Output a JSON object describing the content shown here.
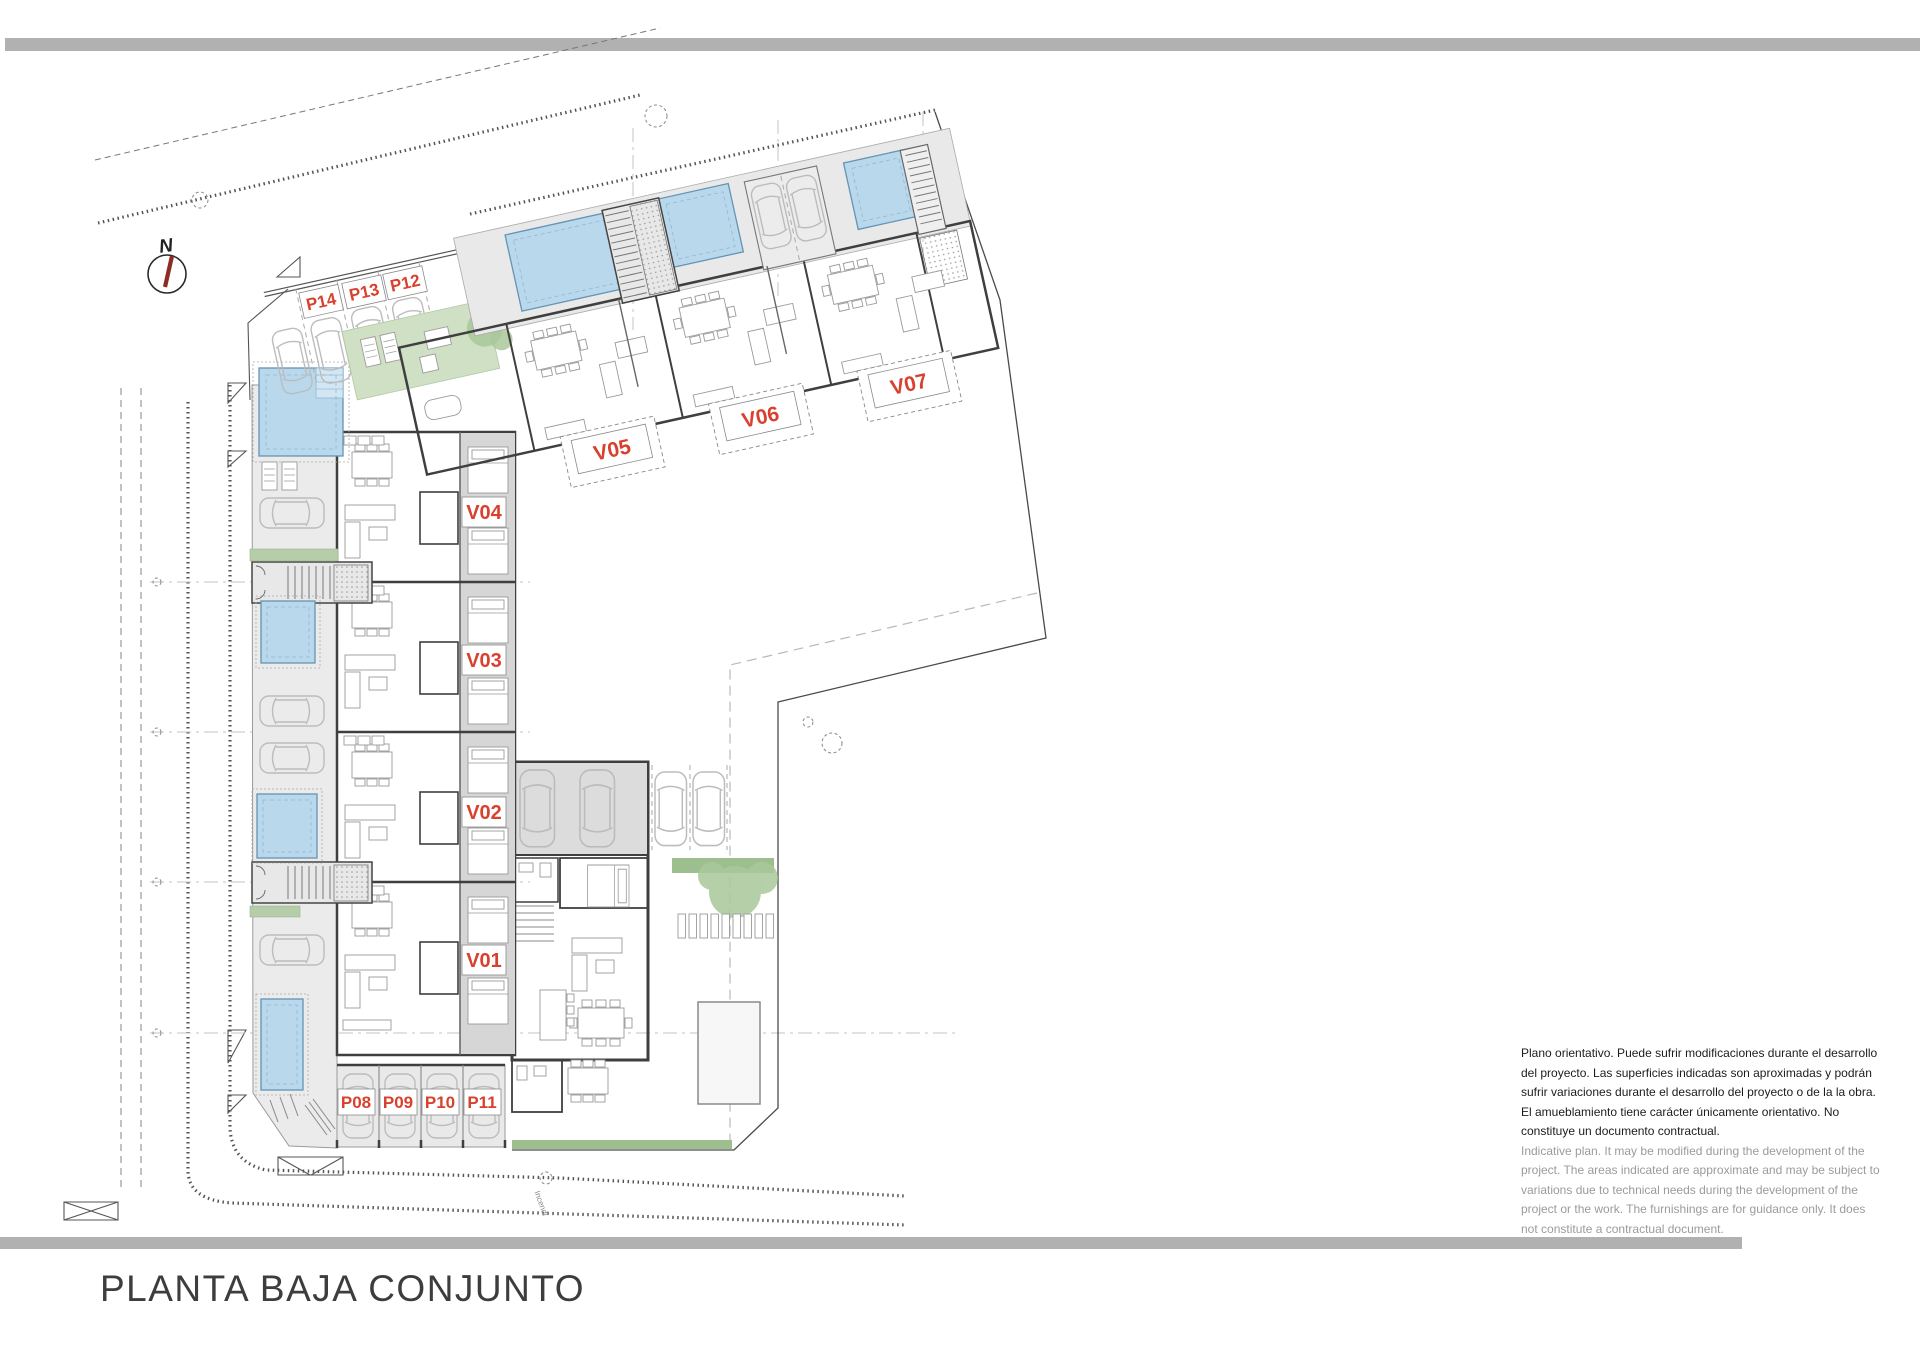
{
  "sheet": {
    "title": "PLANTA BAJA CONJUNTO",
    "compass_north": "N",
    "site_note": "Incendi"
  },
  "labels": {
    "villas": [
      "V01",
      "V02",
      "V03",
      "V04",
      "V05",
      "V06",
      "V07"
    ],
    "parking": [
      "P08",
      "P09",
      "P10",
      "P11",
      "P12",
      "P13",
      "P14"
    ]
  },
  "disclaimer": {
    "es_lines": [
      "Plano orientativo. Puede sufrir modificaciones durante el desarrollo",
      "del proyecto. Las superficies indicadas son aproximadas y podrán",
      "sufrir variaciones durante el desarrollo del proyecto o de la la obra.",
      "El amueblamiento tiene carácter únicamente orientativo. No",
      "constituye un documento contractual."
    ],
    "en_lines": [
      "Indicative plan. It may be modified during the development of the",
      "project. The areas indicated are approximate and may be subject to",
      "variations due to technical needs during the development of the",
      "project or the work. The furnishings are for guidance only. It does",
      "not constitute a contractual document."
    ]
  },
  "colors": {
    "accent_red": "#d9402e",
    "pool_blue": "#b9d8ec",
    "lawn_green": "#cfe0c4",
    "hedge_green": "#9dbf90",
    "bar_gray": "#b1b1b1",
    "wall_dark": "#3f3f3f"
  }
}
